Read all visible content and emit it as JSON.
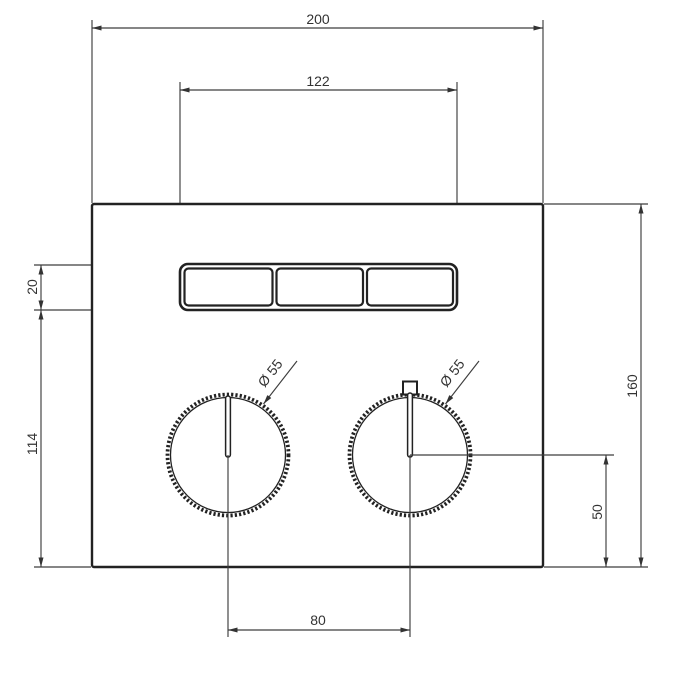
{
  "drawing": {
    "kind": "technical-dimension-drawing",
    "subject": "wall plate with three buttons and two knurled knobs, front view",
    "background_color": "#ffffff",
    "object_line_color": "#222222",
    "dimension_line_color": "#3d3d3d",
    "text_color": "#333333",
    "dims": {
      "overall_width": "200",
      "buttons_width": "122",
      "button_height": "20",
      "lower_body_height": "114",
      "overall_height": "160",
      "knob_axis_to_bottom": "50",
      "knob_spacing": "80",
      "left_knob_diameter": "Ø 55",
      "right_knob_diameter": "Ø 55"
    }
  }
}
